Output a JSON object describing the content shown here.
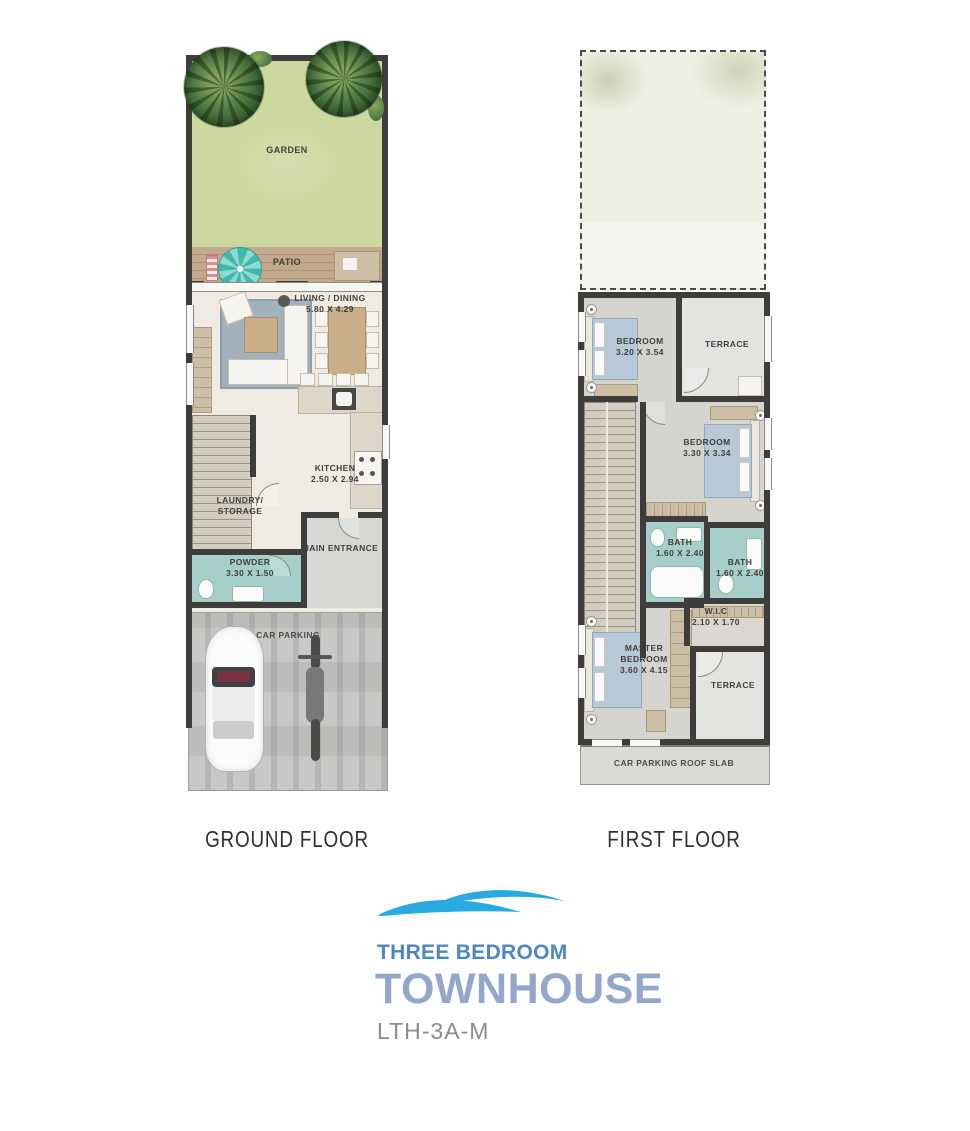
{
  "ground_floor": {
    "title": "GROUND FLOOR",
    "rooms": {
      "garden": {
        "label": "GARDEN"
      },
      "patio": {
        "label": "PATIO"
      },
      "living_dining": {
        "label": "LIVING / DINING",
        "dims": "5.80 X 4.29"
      },
      "kitchen": {
        "label": "KITCHEN",
        "dims": "2.50 X 2.94"
      },
      "laundry_storage": {
        "label": "LAUNDRY/ STORAGE"
      },
      "main_entrance": {
        "label": "MAIN ENTRANCE"
      },
      "powder": {
        "label": "POWDER",
        "dims": "3.30 X 1.50"
      },
      "car_parking": {
        "label": "CAR PARKING"
      }
    }
  },
  "first_floor": {
    "title": "FIRST FLOOR",
    "rooms": {
      "bedroom_1": {
        "label": "BEDROOM",
        "dims": "3.20 X 3.54"
      },
      "terrace_upper": {
        "label": "TERRACE"
      },
      "bedroom_2": {
        "label": "BEDROOM",
        "dims": "3.30 X 3.34"
      },
      "bath_1": {
        "label": "BATH",
        "dims": "1.60 X 2.40"
      },
      "bath_2": {
        "label": "BATH",
        "dims": "1.60 X 2.40"
      },
      "wic": {
        "label": "W.I.C",
        "dims": "2.10 X 1.70"
      },
      "master_bedroom": {
        "label": "MASTER BEDROOM",
        "dims": "3.60 X 4.15"
      },
      "terrace_lower": {
        "label": "TERRACE"
      },
      "roof_slab": {
        "label": "CAR PARKING ROOF SLAB"
      }
    }
  },
  "branding": {
    "type_line": "THREE BEDROOM",
    "product_line": "TOWNHOUSE",
    "unit_code": "LTH-3A-M"
  },
  "colors": {
    "wall": "#3e3d3b",
    "garden": "#ccd8a0",
    "patio": "#c2a98b",
    "floor": "#efebe2",
    "bath": "#a7cfc9",
    "entrance": "#d6d8d4",
    "parking": "#c5c6c2",
    "bedroomFloor": "#d6d4ce",
    "terrace": "#e3e4e0",
    "slab": "#dadbd7",
    "bed": "#b7c8d6",
    "furniture": "#cdbfa6",
    "counter": "#ddd7ca",
    "rug": "#a3b1bd",
    "stairs": "#d4cec1",
    "labelInk": "#3f3f3c",
    "titleInk": "#2f2f2f",
    "brandWave": "#29abe2",
    "brandBlue": "#4d87c0",
    "brandLight": "#92a7c9",
    "brandGray": "#8b8b8b"
  }
}
